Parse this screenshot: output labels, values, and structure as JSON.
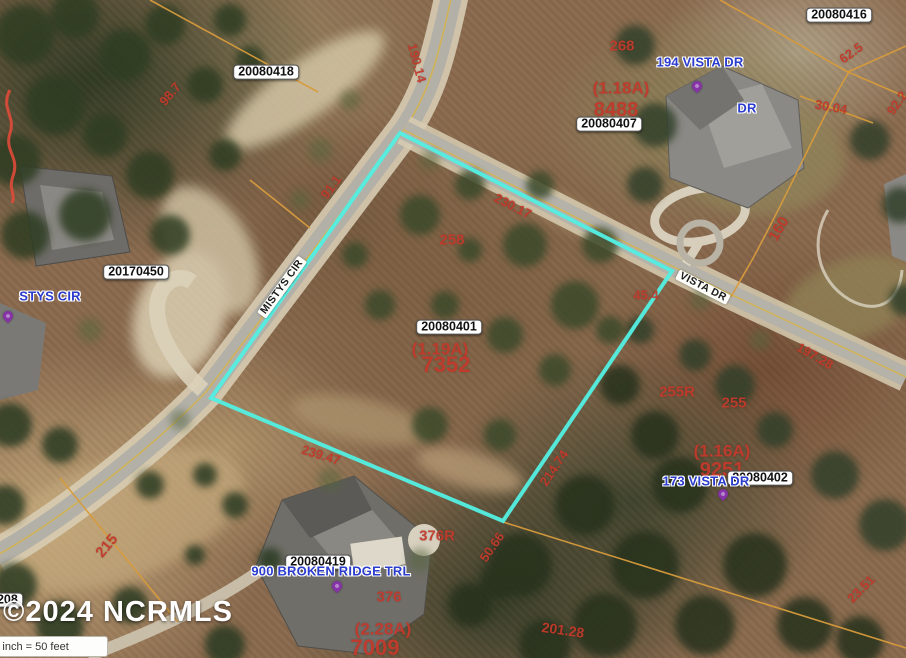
{
  "map": {
    "copyright": "©2024 NCRMLS",
    "scale_label": "1 inch = 50 feet",
    "colors": {
      "highlight": "#53EEE1",
      "parcel_line": "#D79B3C",
      "dimension_text": "#C23A2C",
      "address_text": "#2A3BCE",
      "pin": "#8633A8",
      "red_curve": "#E04A3A"
    },
    "subject_parcel": {
      "id": "20080401",
      "acreage": "(1.19A)",
      "lot_number": "7352"
    }
  },
  "annotations": {
    "parcel_ids": [
      {
        "text": "20080418",
        "x": 266,
        "y": 72
      },
      {
        "text": "20080416",
        "x": 839,
        "y": 15
      },
      {
        "text": "20080407",
        "x": 609,
        "y": 124
      },
      {
        "text": "20170450",
        "x": 136,
        "y": 272
      },
      {
        "text": "20080401",
        "x": 449,
        "y": 327
      },
      {
        "text": "20080402",
        "x": 760,
        "y": 478
      },
      {
        "text": "20080419",
        "x": 318,
        "y": 562
      },
      {
        "text": "20080208",
        "x": -10,
        "y": 600
      }
    ],
    "addresses": [
      {
        "text": "194 VISTA DR",
        "x": 700,
        "y": 62,
        "pin": {
          "x": 697,
          "y": 90
        }
      },
      {
        "text": "STYS CIR",
        "x": 50,
        "y": 296,
        "pin": {
          "x": 8,
          "y": 320
        }
      },
      {
        "text": "173 VISTA DR",
        "x": 706,
        "y": 481,
        "pin": {
          "x": 723,
          "y": 498
        }
      },
      {
        "text": "900 BROKEN RIDGE TRL",
        "x": 331,
        "y": 571,
        "pin": {
          "x": 337,
          "y": 590
        }
      },
      {
        "text": "DR",
        "x": 747,
        "y": 108
      }
    ],
    "road_labels": [
      {
        "text": "VISTA DR",
        "x": 703,
        "y": 287,
        "rot": 27
      },
      {
        "text": "MISTYS CIR",
        "x": 282,
        "y": 287,
        "rot": -54
      }
    ],
    "dimensions": [
      {
        "text": "190.14",
        "x": 417,
        "y": 63,
        "rot": 75,
        "size": 13
      },
      {
        "text": "98.7",
        "x": 170,
        "y": 94,
        "rot": -50,
        "size": 13
      },
      {
        "text": "268",
        "x": 622,
        "y": 46,
        "rot": 0,
        "size": 15
      },
      {
        "text": "(1.18A)",
        "x": 621,
        "y": 88,
        "rot": 0,
        "size": 17
      },
      {
        "text": "8488",
        "x": 616,
        "y": 110,
        "rot": 0,
        "size": 20
      },
      {
        "text": "30.04",
        "x": 831,
        "y": 107,
        "rot": 10,
        "size": 13
      },
      {
        "text": "62.5",
        "x": 851,
        "y": 53,
        "rot": -36,
        "size": 13
      },
      {
        "text": "92.2",
        "x": 897,
        "y": 103,
        "rot": -55,
        "size": 13
      },
      {
        "text": "160",
        "x": 779,
        "y": 229,
        "rot": -60,
        "size": 15
      },
      {
        "text": "231.94",
        "x": 291,
        "y": 277,
        "rot": -54,
        "size": 13
      },
      {
        "text": "91.1",
        "x": 331,
        "y": 187,
        "rot": -54,
        "size": 13
      },
      {
        "text": "230.17",
        "x": 513,
        "y": 206,
        "rot": 27,
        "size": 13
      },
      {
        "text": "258",
        "x": 452,
        "y": 240,
        "rot": 0,
        "size": 15
      },
      {
        "text": "45.4",
        "x": 646,
        "y": 295,
        "rot": 0,
        "size": 13
      },
      {
        "text": "(1.19A)",
        "x": 440,
        "y": 349,
        "rot": 0,
        "size": 17
      },
      {
        "text": "7352",
        "x": 446,
        "y": 365,
        "rot": 0,
        "size": 22
      },
      {
        "text": "214.74",
        "x": 554,
        "y": 468,
        "rot": -56,
        "size": 13
      },
      {
        "text": "239.47",
        "x": 321,
        "y": 455,
        "rot": 17,
        "size": 13
      },
      {
        "text": "376R",
        "x": 437,
        "y": 536,
        "rot": 0,
        "size": 15
      },
      {
        "text": "50.66",
        "x": 492,
        "y": 547,
        "rot": -55,
        "size": 13
      },
      {
        "text": "255R",
        "x": 677,
        "y": 392,
        "rot": 0,
        "size": 15
      },
      {
        "text": "255",
        "x": 734,
        "y": 403,
        "rot": 0,
        "size": 15
      },
      {
        "text": "(1.16A)",
        "x": 722,
        "y": 451,
        "rot": 0,
        "size": 17
      },
      {
        "text": "9251",
        "x": 722,
        "y": 470,
        "rot": 0,
        "size": 20
      },
      {
        "text": "197.28",
        "x": 815,
        "y": 356,
        "rot": 30,
        "size": 13
      },
      {
        "text": "376",
        "x": 389,
        "y": 597,
        "rot": 0,
        "size": 15
      },
      {
        "text": "(2.28A)",
        "x": 383,
        "y": 629,
        "rot": 0,
        "size": 17
      },
      {
        "text": "7009",
        "x": 375,
        "y": 648,
        "rot": 0,
        "size": 22
      },
      {
        "text": "201.28",
        "x": 563,
        "y": 630,
        "rot": 8,
        "size": 14
      },
      {
        "text": "23.51",
        "x": 861,
        "y": 589,
        "rot": -45,
        "size": 13
      },
      {
        "text": "215",
        "x": 107,
        "y": 546,
        "rot": -50,
        "size": 15
      }
    ]
  }
}
